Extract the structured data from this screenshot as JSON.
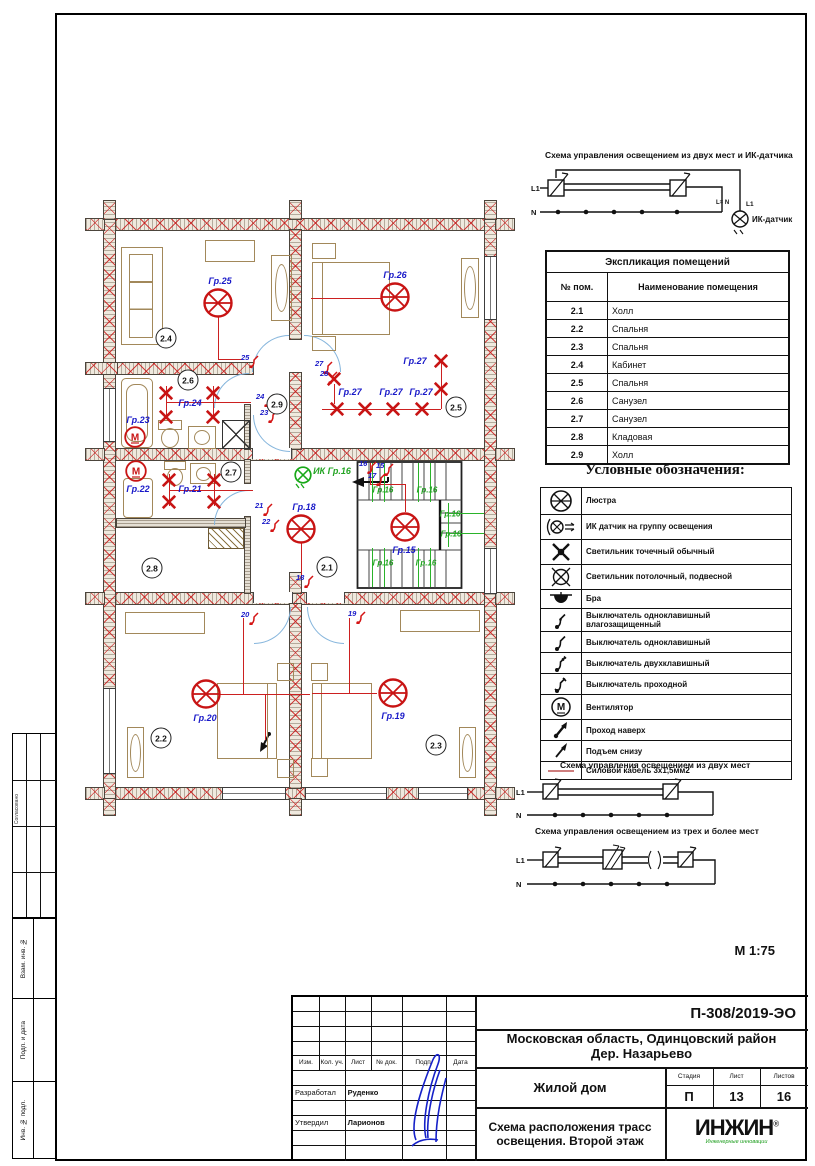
{
  "main": {
    "scale": "М 1:75"
  },
  "sidebar": {
    "approved": "Согласовано",
    "vzam": "Взам. инв. №",
    "podp": "Подп. и дата",
    "inv": "Инв. № подл."
  },
  "schemas": {
    "top": {
      "title": "Схема управления освещением из двух мест и ИК-датчика",
      "l1": "L1",
      "n": "N",
      "l1_right": "L1",
      "n_right": "L= N",
      "sensor": "ИК-датчик"
    },
    "two": {
      "title": "Схема управления освещением из двух мест",
      "l1": "L1",
      "n": "N"
    },
    "three": {
      "title": "Схема управления освещением из трех и более мест",
      "l1": "L1",
      "n": "N"
    }
  },
  "room_table": {
    "title": "Экспликация помещений",
    "col1": "№ пом.",
    "col2": "Наименование помещения",
    "rows": [
      [
        "2.1",
        "Холл"
      ],
      [
        "2.2",
        "Спальня"
      ],
      [
        "2.3",
        "Спальня"
      ],
      [
        "2.4",
        "Кабинет"
      ],
      [
        "2.5",
        "Спальня"
      ],
      [
        "2.6",
        "Санузел"
      ],
      [
        "2.7",
        "Санузел"
      ],
      [
        "2.8",
        "Кладовая"
      ],
      [
        "2.9",
        "Холл"
      ]
    ]
  },
  "legend": {
    "title": "Условные обозначения:",
    "items": [
      {
        "icon": "lustra",
        "label": "Люстра"
      },
      {
        "icon": "ik",
        "label": "ИК датчик на группу освещения"
      },
      {
        "icon": "point",
        "label": "Светильник точечный обычный"
      },
      {
        "icon": "ceiling",
        "label": "Светильник потолочный, подвесной"
      },
      {
        "icon": "sconce",
        "label": "Бра"
      },
      {
        "icon": "sw1w",
        "label": "Выключатель одноклавишный влагозащищенный"
      },
      {
        "icon": "sw1",
        "label": "Выключатель одноклавишный"
      },
      {
        "icon": "sw2",
        "label": "Выключатель двухклавишный"
      },
      {
        "icon": "swp",
        "label": "Выключатель проходной"
      },
      {
        "icon": "fan",
        "label": "Вентилятор"
      },
      {
        "icon": "up",
        "label": "Проход наверх"
      },
      {
        "icon": "rise",
        "label": "Подъем снизу"
      },
      {
        "icon": "cable",
        "label": "Силовой кабель 3х1,5мм2"
      }
    ]
  },
  "plan": {
    "rooms": [
      {
        "id": "2.4",
        "x": 166,
        "y": 338
      },
      {
        "id": "2.6",
        "x": 188,
        "y": 380
      },
      {
        "id": "2.9",
        "x": 277,
        "y": 404
      },
      {
        "id": "2.5",
        "x": 456,
        "y": 407
      },
      {
        "id": "2.7",
        "x": 231,
        "y": 472
      },
      {
        "id": "2.8",
        "x": 152,
        "y": 568
      },
      {
        "id": "2.1",
        "x": 327,
        "y": 567
      },
      {
        "id": "2.2",
        "x": 161,
        "y": 738
      },
      {
        "id": "2.3",
        "x": 436,
        "y": 745
      }
    ],
    "chandeliers": [
      {
        "label": "Гр.25",
        "x": 218,
        "y": 303,
        "lx": 220,
        "ly": 281
      },
      {
        "label": "Гр.26",
        "x": 395,
        "y": 297,
        "lx": 395,
        "ly": 275
      },
      {
        "label": "Гр.18",
        "x": 301,
        "y": 529,
        "lx": 304,
        "ly": 507
      },
      {
        "label": "Гр.15",
        "x": 405,
        "y": 527,
        "lx": 404,
        "ly": 550
      },
      {
        "label": "Гр.20",
        "x": 206,
        "y": 694,
        "lx": 205,
        "ly": 718
      },
      {
        "label": "Гр.19",
        "x": 393,
        "y": 693,
        "lx": 393,
        "ly": 716
      }
    ],
    "fans": [
      {
        "label": "Гр.23",
        "x": 135,
        "y": 437,
        "lx": 138,
        "ly": 420
      },
      {
        "label": "Гр.22",
        "x": 136,
        "y": 471,
        "lx": 138,
        "ly": 489
      }
    ],
    "pointlights": [
      {
        "x": 166,
        "y": 393
      },
      {
        "x": 213,
        "y": 393
      },
      {
        "x": 166,
        "y": 417
      },
      {
        "x": 213,
        "y": 417
      },
      {
        "x": 169,
        "y": 480
      },
      {
        "x": 214,
        "y": 480
      },
      {
        "x": 169,
        "y": 502
      },
      {
        "x": 214,
        "y": 502
      },
      {
        "x": 334,
        "y": 379
      },
      {
        "x": 337,
        "y": 409
      },
      {
        "x": 365,
        "y": 409
      },
      {
        "x": 393,
        "y": 409
      },
      {
        "x": 422,
        "y": 409
      },
      {
        "x": 441,
        "y": 361
      },
      {
        "x": 441,
        "y": 389
      }
    ],
    "group_labels": [
      {
        "text": "Гр.24",
        "x": 190,
        "y": 403
      },
      {
        "text": "Гр.21",
        "x": 190,
        "y": 489
      },
      {
        "text": "Гр.27",
        "x": 350,
        "y": 392
      },
      {
        "text": "Гр.27",
        "x": 391,
        "y": 392
      },
      {
        "text": "Гр.27",
        "x": 421,
        "y": 392
      },
      {
        "text": "Гр.27",
        "x": 415,
        "y": 361
      }
    ],
    "green_labels": [
      {
        "text": "Гр.16",
        "x": 383,
        "y": 490
      },
      {
        "text": "Гр.16",
        "x": 427,
        "y": 490
      },
      {
        "text": "Гр.16",
        "x": 450,
        "y": 514
      },
      {
        "text": "Гр.16",
        "x": 451,
        "y": 534
      },
      {
        "text": "Гр.16",
        "x": 383,
        "y": 563
      },
      {
        "text": "Гр.16",
        "x": 426,
        "y": 563
      }
    ],
    "ir": {
      "label": "ИК Гр.16",
      "x": 303,
      "y": 476,
      "lx": 332,
      "ly": 471
    },
    "switches": [
      {
        "n": "25",
        "x": 241,
        "y": 353
      },
      {
        "n": "27",
        "x": 315,
        "y": 359
      },
      {
        "n": "28",
        "x": 320,
        "y": 369
      },
      {
        "n": "24",
        "x": 256,
        "y": 392
      },
      {
        "n": "23",
        "x": 260,
        "y": 408
      },
      {
        "n": "21",
        "x": 255,
        "y": 501
      },
      {
        "n": "22",
        "x": 262,
        "y": 517
      },
      {
        "n": "16",
        "x": 359,
        "y": 459
      },
      {
        "n": "15",
        "x": 376,
        "y": 461
      },
      {
        "n": "17",
        "x": 368,
        "y": 471
      },
      {
        "n": "18",
        "x": 296,
        "y": 573
      },
      {
        "n": "20",
        "x": 241,
        "y": 610
      },
      {
        "n": "19",
        "x": 348,
        "y": 609
      }
    ],
    "red_lines": [
      [
        218,
        316,
        218,
        359
      ],
      [
        218,
        359,
        241,
        359
      ],
      [
        311,
        298,
        381,
        298
      ],
      [
        322,
        409,
        441,
        409
      ],
      [
        441,
        361,
        441,
        409
      ],
      [
        334,
        384,
        334,
        404
      ],
      [
        166,
        386,
        166,
        418
      ],
      [
        213,
        386,
        213,
        418
      ],
      [
        166,
        402,
        251,
        402
      ],
      [
        169,
        474,
        169,
        506
      ],
      [
        214,
        474,
        214,
        506
      ],
      [
        169,
        490,
        253,
        490
      ],
      [
        301,
        543,
        301,
        575
      ],
      [
        405,
        484,
        405,
        512
      ],
      [
        370,
        484,
        405,
        484
      ],
      [
        370,
        463,
        370,
        484
      ],
      [
        243,
        618,
        243,
        694
      ],
      [
        220,
        694,
        310,
        694
      ],
      [
        349,
        618,
        349,
        693
      ],
      [
        312,
        693,
        377,
        693
      ],
      [
        265,
        694,
        265,
        740
      ]
    ],
    "green_lines": [
      [
        372,
        463,
        372,
        502
      ],
      [
        384,
        463,
        384,
        502
      ],
      [
        418,
        463,
        418,
        502
      ],
      [
        430,
        463,
        430,
        502
      ],
      [
        372,
        548,
        372,
        587
      ],
      [
        384,
        548,
        384,
        587
      ],
      [
        418,
        548,
        418,
        587
      ],
      [
        430,
        548,
        430,
        587
      ],
      [
        448,
        503,
        448,
        547
      ],
      [
        448,
        513,
        484,
        513
      ],
      [
        448,
        533,
        484,
        533
      ]
    ]
  },
  "titleblock": {
    "doc": "П-308/2019-ЭО",
    "loc1": "Московская область, Одинцовский район",
    "loc2": "Дер. Назарьево",
    "object": "Жилой дом",
    "sheet_title1": "Схема расположения трасс",
    "sheet_title2": "освещения. Второй этаж",
    "stage_label": "Стадия",
    "sheet_label": "Лист",
    "sheets_label": "Листов",
    "stage": "П",
    "sheet": "13",
    "sheets": "16",
    "header": [
      "Изм.",
      "Кол. уч.",
      "Лист",
      "№ док.",
      "Подп.",
      "Дата"
    ],
    "roles": [
      {
        "role": "Разработал",
        "name": "Руденко"
      },
      {
        "role": "Утвердил",
        "name": "Ларионов"
      }
    ],
    "logo": "ИНЖИН",
    "logo_reg": "®",
    "logo_sub": "Инженерные инновации"
  }
}
